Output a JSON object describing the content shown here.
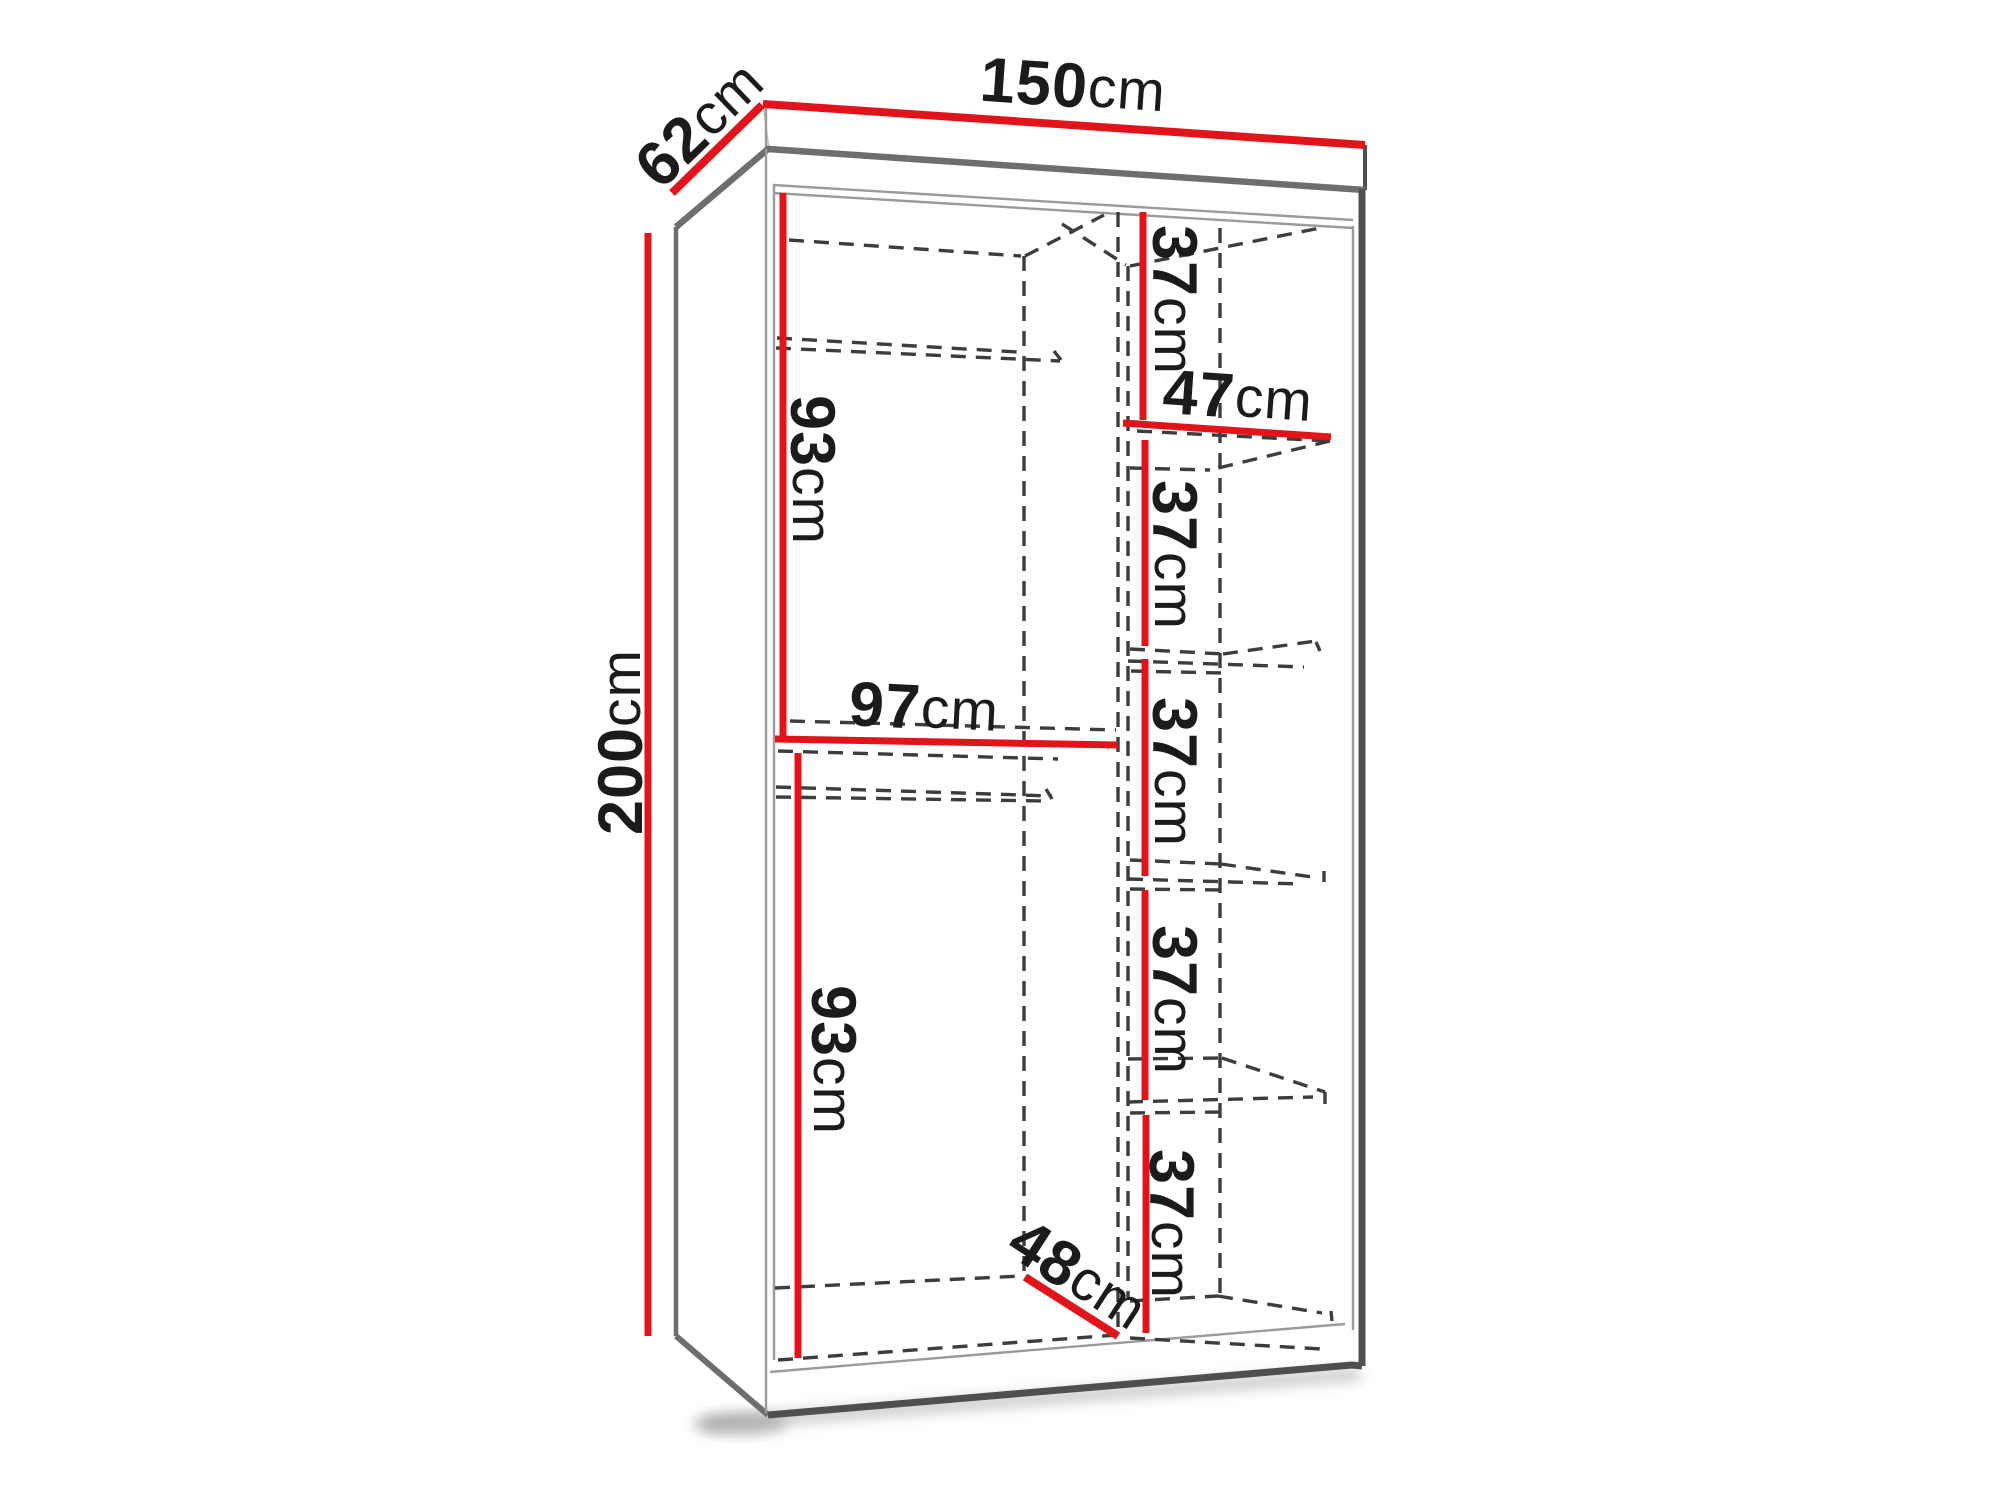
{
  "diagram": {
    "title": "wardrobe-dimensions",
    "colors": {
      "dimension_line": "#e1141b",
      "carcass_edge": "#6e6e6e",
      "hidden_edge": "#3d3d3d",
      "text": "#1b1b1b",
      "background": "#ffffff"
    },
    "dims": {
      "width": {
        "value": "150",
        "unit": "cm"
      },
      "depth": {
        "value": "62",
        "unit": "cm"
      },
      "height": {
        "value": "200",
        "unit": "cm"
      },
      "left_upper_section_height": {
        "value": "93",
        "unit": "cm"
      },
      "left_section_width": {
        "value": "97",
        "unit": "cm"
      },
      "left_lower_section_height": {
        "value": "93",
        "unit": "cm"
      },
      "right_shelf_width": {
        "value": "47",
        "unit": "cm"
      },
      "usable_depth": {
        "value": "48",
        "unit": "cm"
      },
      "shelf_gaps": [
        {
          "value": "37",
          "unit": "cm"
        },
        {
          "value": "37",
          "unit": "cm"
        },
        {
          "value": "37",
          "unit": "cm"
        },
        {
          "value": "37",
          "unit": "cm"
        },
        {
          "value": "37",
          "unit": "cm"
        }
      ]
    }
  }
}
